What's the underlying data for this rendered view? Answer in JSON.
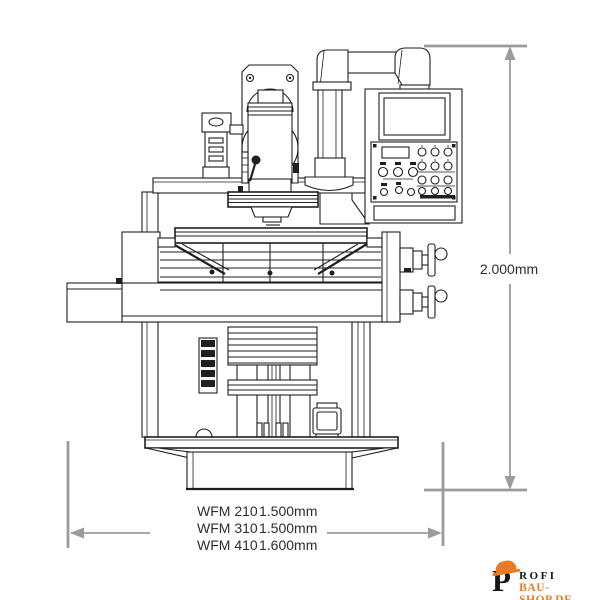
{
  "colors": {
    "line": "#1f1f1f",
    "dim": "#9b9b9b",
    "text": "#2e2e2e",
    "accent_orange": "#e87c26",
    "background": "#ffffff"
  },
  "dimensions": {
    "height_label": "2.000mm",
    "width_rows": [
      {
        "model": "WFM 210",
        "value": "1.500mm"
      },
      {
        "model": "WFM 310",
        "value": "1.500mm"
      },
      {
        "model": "WFM 410",
        "value": "1.600mm"
      }
    ]
  },
  "logo": {
    "initial": "P",
    "name_rest": "ROFI",
    "domain": "BAU-SHOP.DE"
  }
}
